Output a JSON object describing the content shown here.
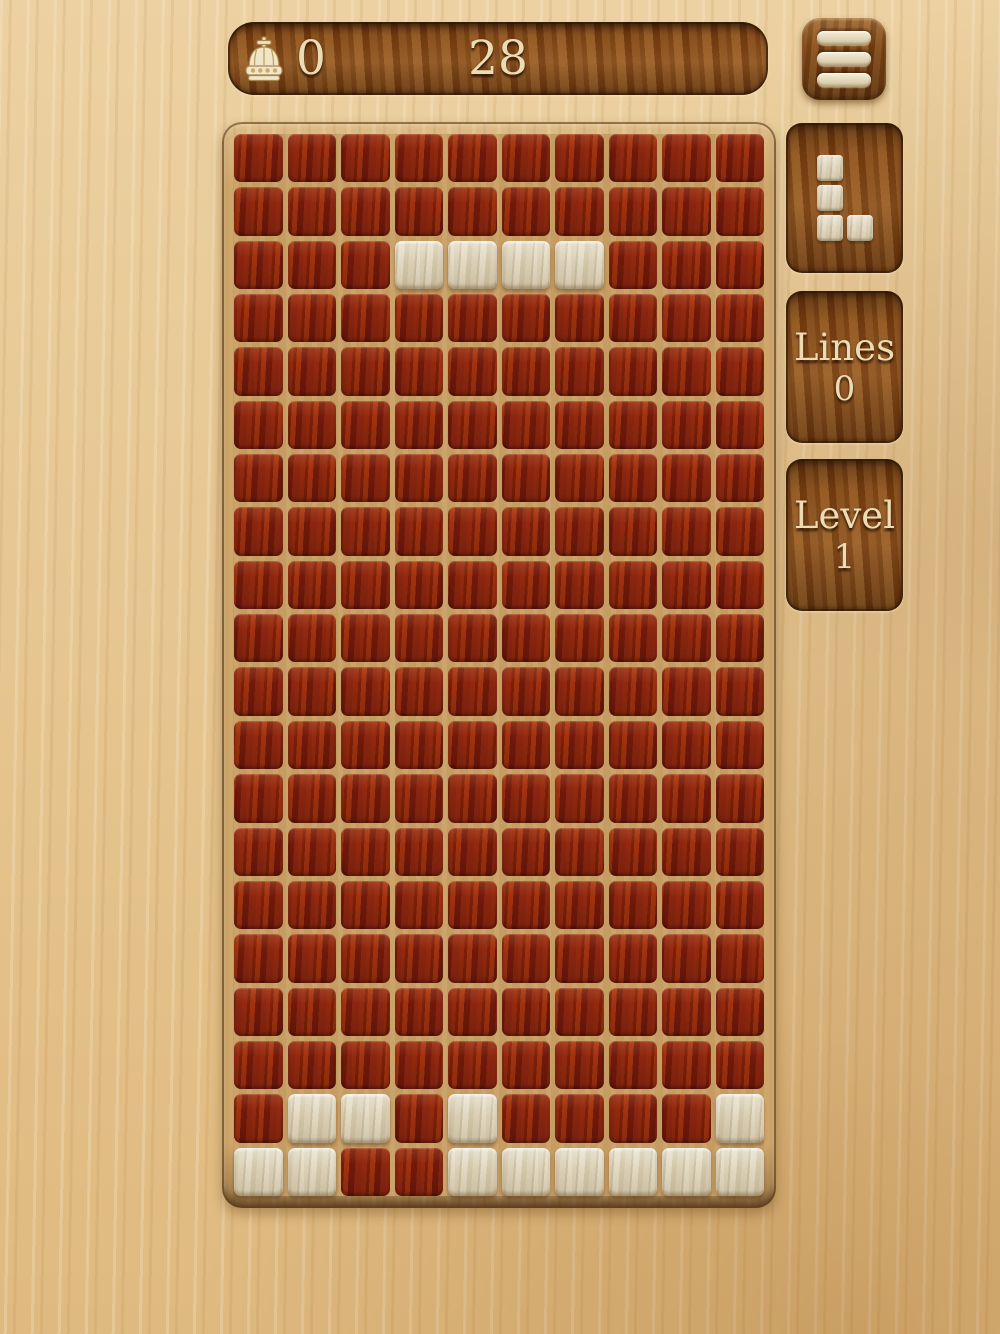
{
  "score_bar": {
    "best_score": "0",
    "score": "28"
  },
  "menu_button": {
    "icon": "hamburger-menu-icon"
  },
  "sidebar": {
    "next_piece": {
      "name": "L-piece",
      "cells_col_row": [
        [
          0,
          0
        ],
        [
          0,
          1
        ],
        [
          0,
          2
        ],
        [
          1,
          2
        ]
      ]
    },
    "lines": {
      "label": "Lines",
      "value": "0"
    },
    "level": {
      "label": "Level",
      "value": "1"
    }
  },
  "board": {
    "cols": 10,
    "rows": 20,
    "light_cells_row_col": [
      [
        2,
        3
      ],
      [
        2,
        4
      ],
      [
        2,
        5
      ],
      [
        2,
        6
      ],
      [
        18,
        1
      ],
      [
        18,
        2
      ],
      [
        18,
        4
      ],
      [
        18,
        9
      ],
      [
        19,
        0
      ],
      [
        19,
        1
      ],
      [
        19,
        4
      ],
      [
        19,
        5
      ],
      [
        19,
        6
      ],
      [
        19,
        7
      ],
      [
        19,
        8
      ],
      [
        19,
        9
      ]
    ]
  },
  "colors": {
    "background_wood": "#e5c48e",
    "panel_wood": "#7f4818",
    "board_frame": "#d0a76b",
    "board_grout": "#c59c62",
    "red_tile": "#88230d",
    "light_tile": "#d7cbb0",
    "text_cream": "#eddcb3"
  }
}
